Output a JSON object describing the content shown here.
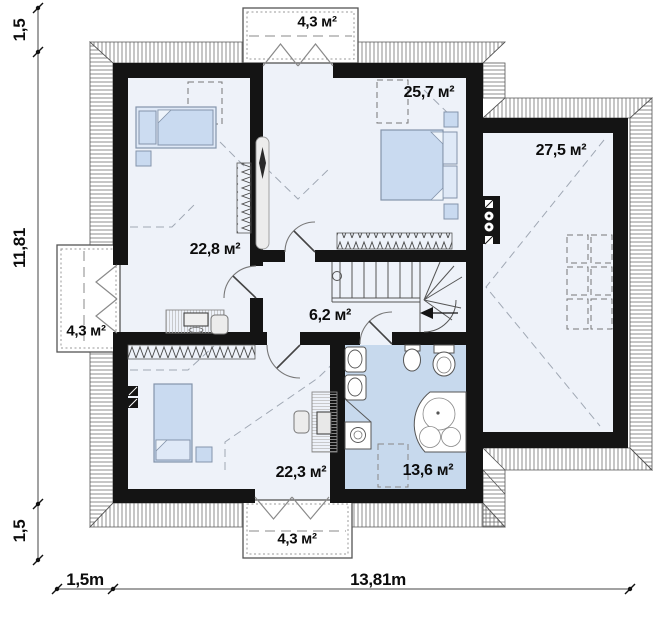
{
  "plan_title": "attic floor plan",
  "rooms": [
    {
      "name": "bedroom-upper-left",
      "area": "22,8 м²"
    },
    {
      "name": "bedroom-upper-right",
      "area": "25,7 м²"
    },
    {
      "name": "room-right",
      "area": "27,5 м²"
    },
    {
      "name": "hallway",
      "area": "6,2 м²"
    },
    {
      "name": "bedroom-lower-left",
      "area": "22,3 м²"
    },
    {
      "name": "bathroom",
      "area": "13,6 м²"
    }
  ],
  "balconies": [
    {
      "name": "balcony-top",
      "area": "4,3 м²"
    },
    {
      "name": "balcony-left",
      "area": "4,3 м²"
    },
    {
      "name": "balcony-bottom",
      "area": "4,3 м²"
    }
  ],
  "dimensions": {
    "left_top": "1,5",
    "left_middle": "11,81",
    "left_bottom": "1,5",
    "bottom_left": "1,5m",
    "bottom_total": "13,81m"
  },
  "colors": {
    "wall": "#141414",
    "room_floor": "#eef2f9",
    "bathroom_floor": "#c7d9ed",
    "furniture_blue": "#c9daf0"
  }
}
